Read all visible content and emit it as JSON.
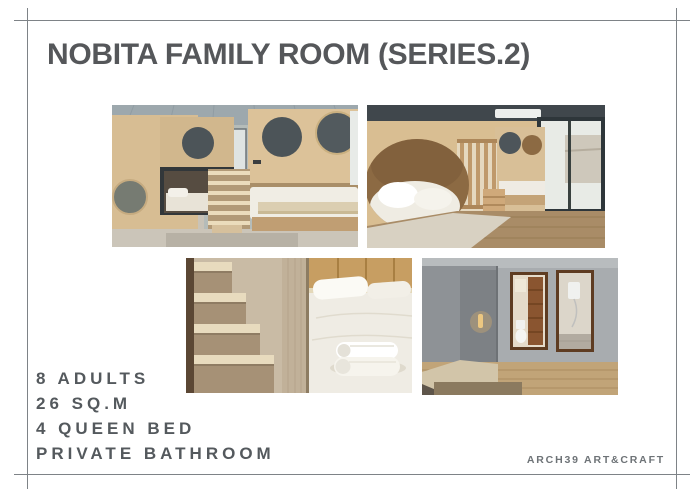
{
  "slide": {
    "title": "NOBITA FAMILY ROOM (SERIES.2)",
    "features": [
      "8 ADULTS",
      "26 SQ.M",
      "4 QUEEN BED",
      "PRIVATE BATHROOM"
    ],
    "credit": "ARCH39 ART&CRAFT",
    "photos": [
      "Bunk room overview with round porthole windows, central wooden staircase and queen bed",
      "Bunk room with large oval bed nook, slatted wood railing and full-height window",
      "Close-up of light wooden staircase beside queen bed with rolled white towels",
      "Gray hallway with wall light and private bathroom: toilet and shower behind wood-framed openings"
    ],
    "colors": {
      "background": "#ffffff",
      "frame_line": "#7e8387",
      "title_text": "#55575a",
      "feature_text": "#54595d",
      "credit_text": "#6e7377",
      "wood_accent": "#d8be94"
    }
  }
}
